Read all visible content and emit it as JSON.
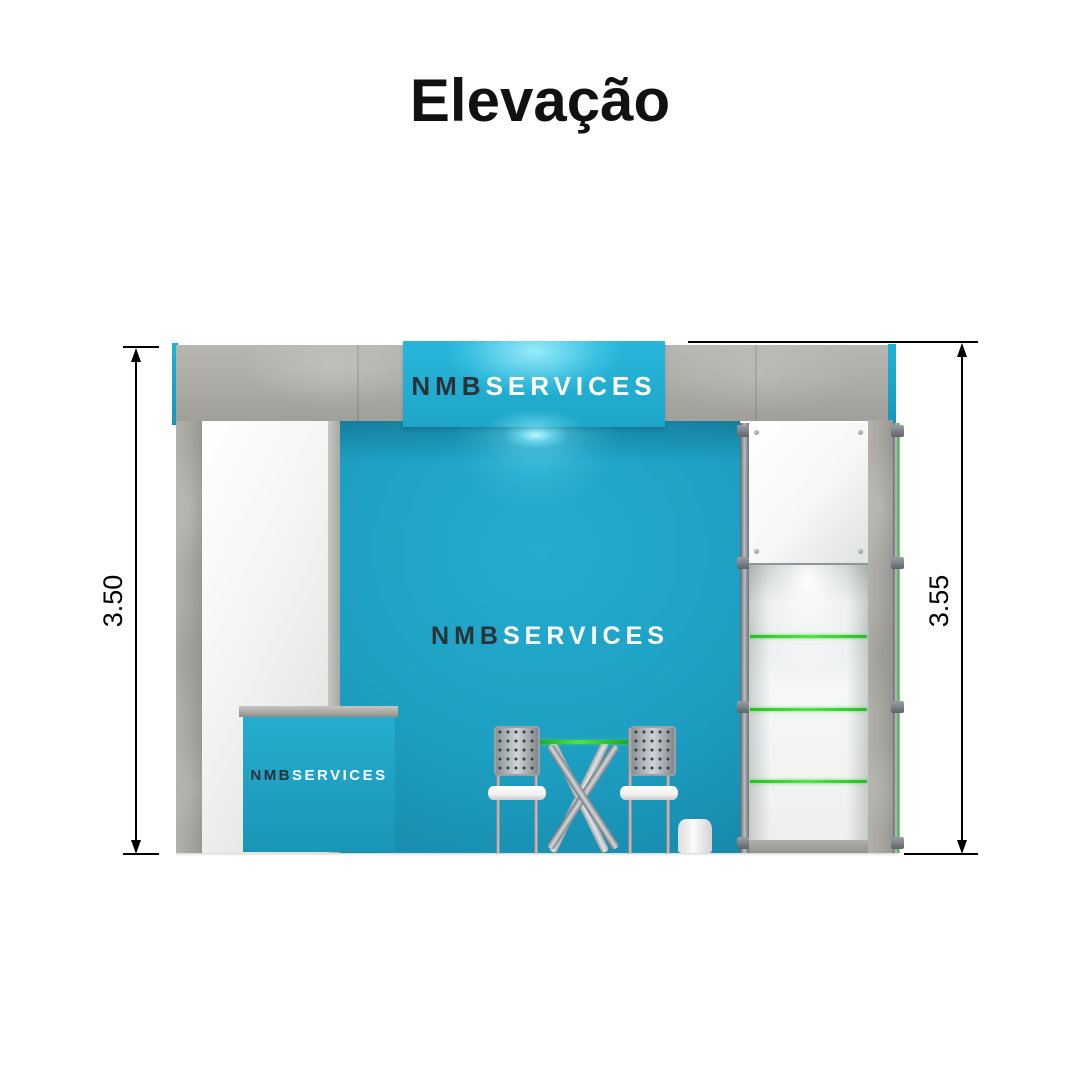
{
  "title": "Elevação",
  "dimensions": {
    "left": "3.50",
    "right": "3.55"
  },
  "branding": {
    "sign": {
      "primary": "NMB",
      "secondary": "SERVICES"
    },
    "wall": {
      "primary": "NMB",
      "secondary": "SERVICES"
    },
    "counter": {
      "primary": "NMB",
      "secondary": "SERVICES"
    }
  },
  "colors": {
    "teal_wall": "#1C9FC2",
    "teal_sign": "#25B2D7",
    "concrete_gray": "#AFAEA9",
    "shelf_green": "#3BD434",
    "brand_dark": "#2A3137",
    "brand_light": "#FFFFFF",
    "dimension_line": "#000000"
  }
}
